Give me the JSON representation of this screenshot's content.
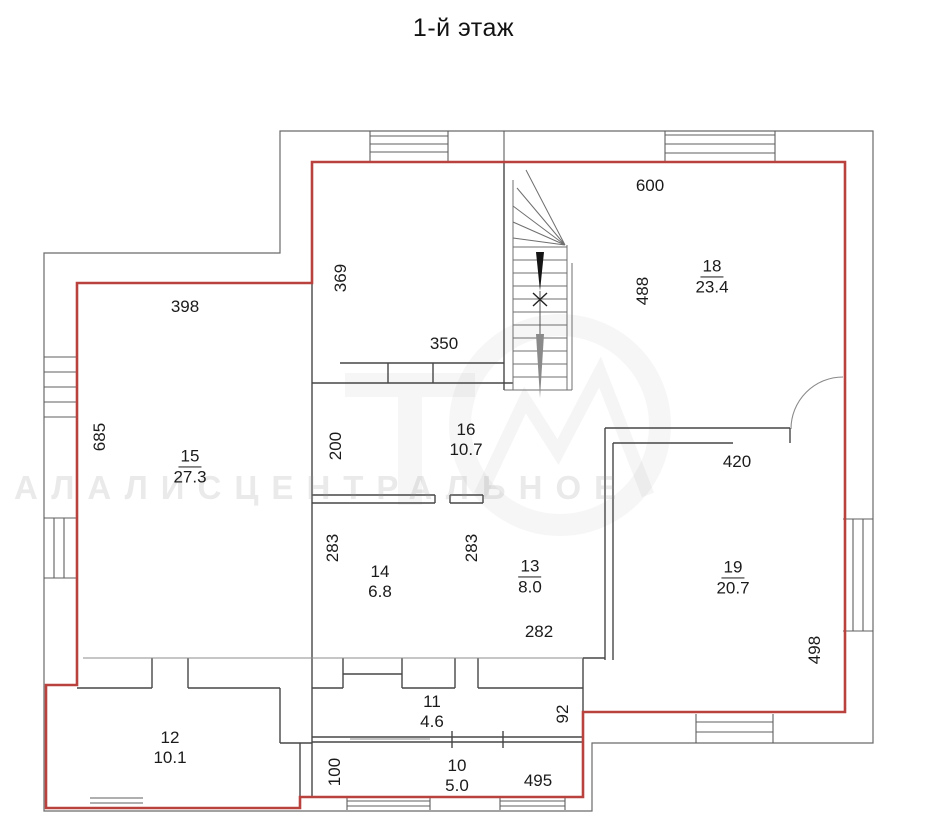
{
  "title": "1-й этаж",
  "colors": {
    "boundary_red": "#ba423e",
    "wall_black": "#474747",
    "thin_gray": "#777777"
  },
  "watermark": {
    "text": "АЛАЛИСЦЕНТРАЛЬНОЕ"
  },
  "rooms": [
    {
      "id": "room-15",
      "number": "15",
      "area": "27.3",
      "underline": true,
      "x": 190,
      "y": 467
    },
    {
      "id": "room-16",
      "number": "16",
      "area": "10.7",
      "underline": false,
      "x": 466,
      "y": 440
    },
    {
      "id": "room-18",
      "number": "18",
      "area": "23.4",
      "underline": true,
      "x": 712,
      "y": 277
    },
    {
      "id": "room-19",
      "number": "19",
      "area": "20.7",
      "underline": true,
      "x": 733,
      "y": 578
    },
    {
      "id": "room-14",
      "number": "14",
      "area": "6.8",
      "underline": false,
      "x": 380,
      "y": 582
    },
    {
      "id": "room-13",
      "number": "13",
      "area": "8.0",
      "underline": true,
      "x": 530,
      "y": 577
    },
    {
      "id": "room-12",
      "number": "12",
      "area": "10.1",
      "underline": false,
      "x": 170,
      "y": 748
    },
    {
      "id": "room-11",
      "number": "11",
      "area": "4.6",
      "underline": false,
      "x": 432,
      "y": 712
    },
    {
      "id": "room-10",
      "number": "10",
      "area": "5.0",
      "underline": false,
      "x": 457,
      "y": 776
    }
  ],
  "dimensions": [
    {
      "id": "dim-398",
      "text": "398",
      "x": 185,
      "y": 307,
      "vertical": false
    },
    {
      "id": "dim-685",
      "text": "685",
      "x": 100,
      "y": 437,
      "vertical": true
    },
    {
      "id": "dim-369",
      "text": "369",
      "x": 341,
      "y": 278,
      "vertical": true
    },
    {
      "id": "dim-350",
      "text": "350",
      "x": 444,
      "y": 344,
      "vertical": false
    },
    {
      "id": "dim-600",
      "text": "600",
      "x": 650,
      "y": 186,
      "vertical": false
    },
    {
      "id": "dim-488",
      "text": "488",
      "x": 643,
      "y": 291,
      "vertical": true
    },
    {
      "id": "dim-200",
      "text": "200",
      "x": 336,
      "y": 446,
      "vertical": true
    },
    {
      "id": "dim-283-left",
      "text": "283",
      "x": 333,
      "y": 548,
      "vertical": true
    },
    {
      "id": "dim-283-mid",
      "text": "283",
      "x": 472,
      "y": 548,
      "vertical": true
    },
    {
      "id": "dim-282",
      "text": "282",
      "x": 539,
      "y": 632,
      "vertical": false
    },
    {
      "id": "dim-420",
      "text": "420",
      "x": 737,
      "y": 462,
      "vertical": false
    },
    {
      "id": "dim-498",
      "text": "498",
      "x": 815,
      "y": 650,
      "vertical": true
    },
    {
      "id": "dim-92",
      "text": "92",
      "x": 563,
      "y": 714,
      "vertical": true
    },
    {
      "id": "dim-100",
      "text": "100",
      "x": 335,
      "y": 772,
      "vertical": true
    },
    {
      "id": "dim-495",
      "text": "495",
      "x": 538,
      "y": 781,
      "vertical": false
    }
  ]
}
